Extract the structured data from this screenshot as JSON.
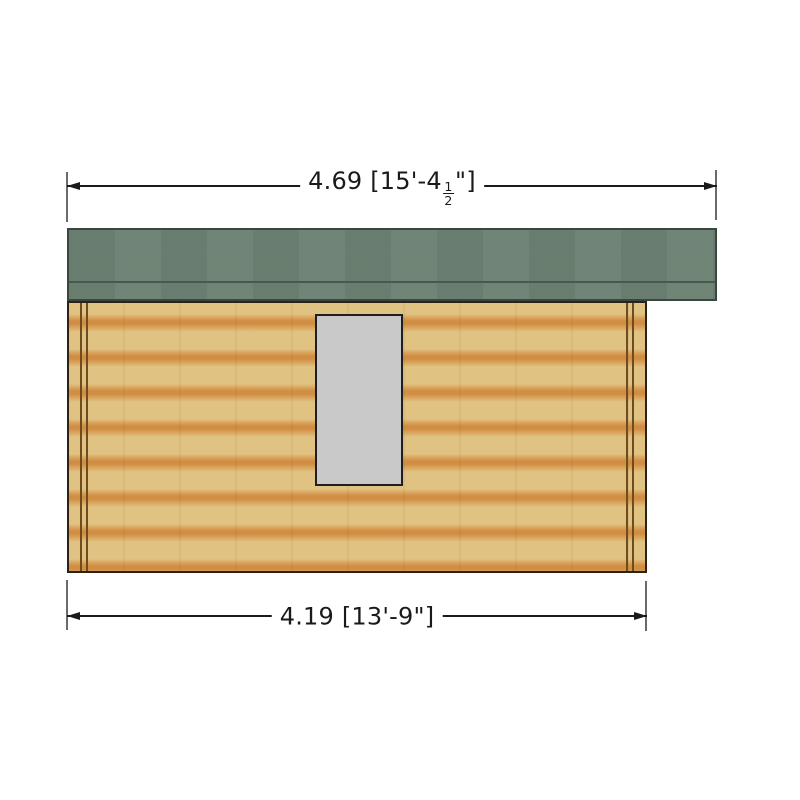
{
  "dimensions": {
    "top": {
      "metric": "4.69",
      "imperial_prefix": "[15'-4",
      "fraction_numerator": "1",
      "fraction_denominator": "2",
      "imperial_suffix": "\"]"
    },
    "bottom": {
      "metric": "4.19",
      "imperial": "[13'-9\"]"
    }
  },
  "colors": {
    "background": "#ffffff",
    "text": "#1a1a1a",
    "dimension_line": "#1a1a1a",
    "extension_line": "#6a6a6a",
    "roof_green": "#6c8173",
    "roof_line": "#49594e",
    "roof_border": "#3a473e",
    "wood_light": "#e0c383",
    "wood_mid": "#d9a158",
    "wood_dark": "#d08e44",
    "trim_brown": "#6e4c1e",
    "wall_border": "#2c2216",
    "window_fill": "#c9c9c9",
    "window_border": "#1f1f1f"
  }
}
